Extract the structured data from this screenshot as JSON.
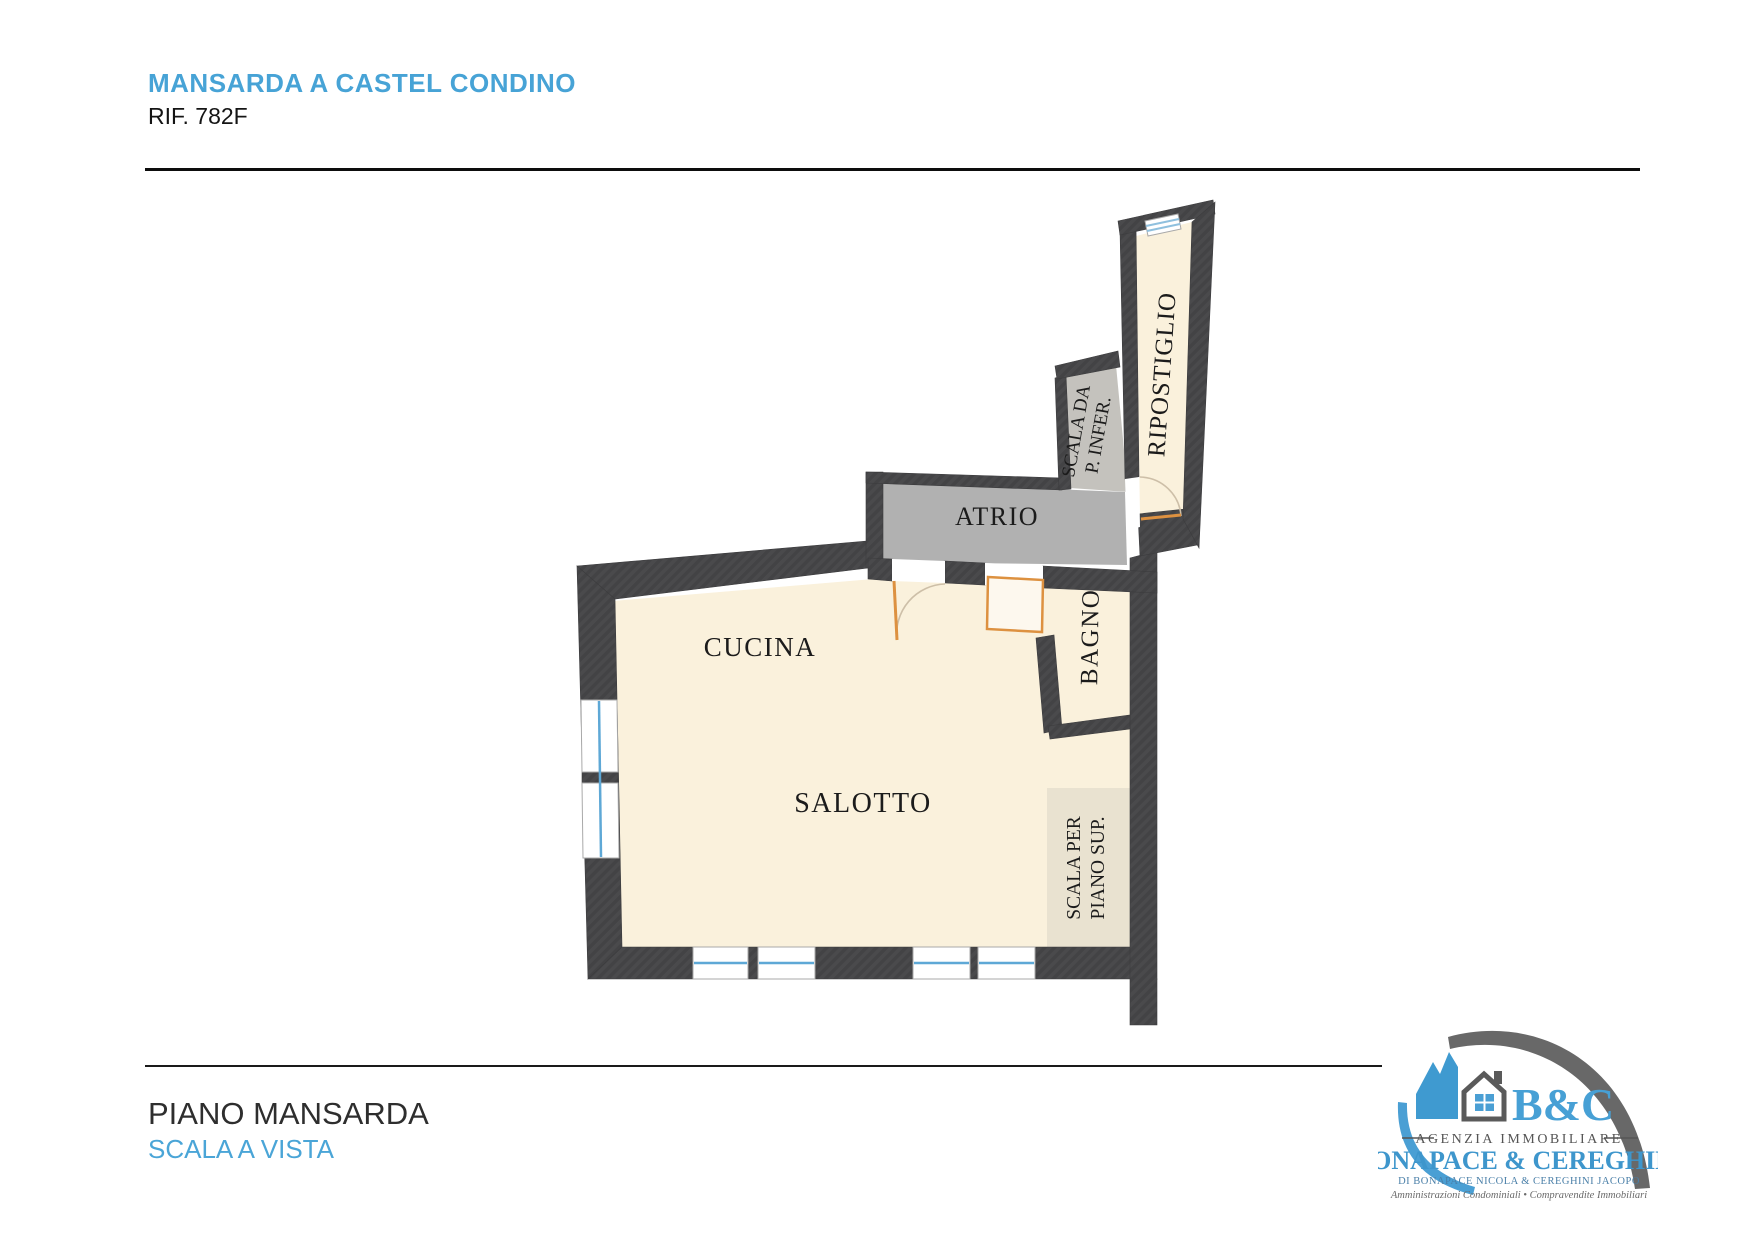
{
  "header": {
    "title": "MANSARDA A CASTEL CONDINO",
    "reference": "RIF. 782F"
  },
  "floorplan": {
    "rooms": {
      "cucina": "CUCINA",
      "salotto": "SALOTTO",
      "atrio": "ATRIO",
      "bagno": "BAGNO",
      "ripostiglio": "RIPOSTIGLIO",
      "scala_da_line1": "SCALA DA",
      "scala_da_line2": "P. INFER.",
      "scala_per_line1": "SCALA PER",
      "scala_per_line2": "PIANO SUP."
    },
    "colors": {
      "wall": "#4a4a4c",
      "room_fill": "#faf1dc",
      "atrio_fill": "#b1b1b1",
      "stair_down_fill": "#c4c2bd",
      "stair_up_fill": "#e9e2d0",
      "window_blue": "#5ea8d6",
      "door_orange": "#dd9140"
    }
  },
  "footer": {
    "floor_label": "PIANO MANSARDA",
    "staircase_note": "SCALA A VISTA"
  },
  "logo": {
    "initials": "B&C",
    "tagline": "AGENZIA IMMOBILIARE",
    "company": "BONAPACE & CEREGHINI",
    "owners": "DI BONAPACE NICOLA & CEREGHINI JACOPO",
    "services": "Amministrazioni Condominiali • Compravendite Immobiliari"
  }
}
